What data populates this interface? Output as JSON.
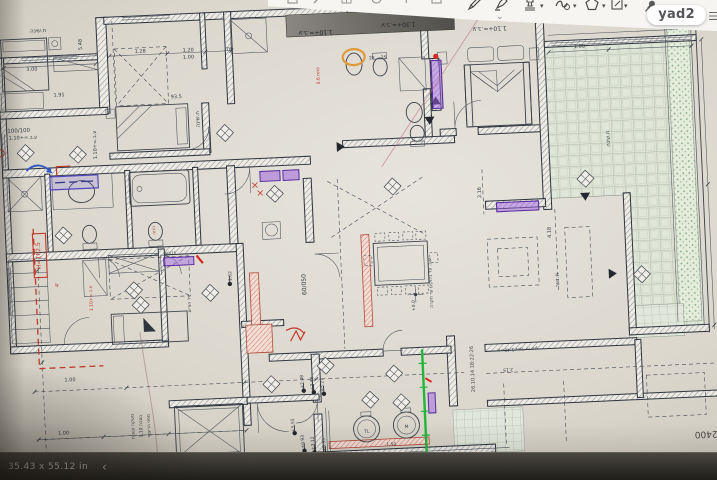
{
  "viewer": {
    "brand": "yad2",
    "size_label": "35.43 x 55.12 in",
    "back_glyph": "‹",
    "menu_glyph": "☰",
    "collapse_glyph": "⌄",
    "caret_glyph": "▾",
    "pencil_glyph": "✎",
    "toolbar_items": [
      "partial-icon",
      "partial-icon",
      "partial-icon",
      "partial-icon",
      "partial-icon",
      "partial-icon",
      "pencil-icon",
      "highlighter-icon",
      "stamp-icon",
      "scribble-icon",
      "shapes-icon",
      "annotate-icon",
      "pin-icon",
      "menu-icon"
    ]
  },
  "plan": {
    "colors": {
      "ink": "#39404a",
      "red": "#c0392b",
      "graphite": "#4a4a44",
      "bartext": "#26272a",
      "green": "#1fae36",
      "purple": "#8e4fd0",
      "orange": "#e09a3c",
      "blue": "#2d57c8",
      "paper": "#dbd7cd"
    },
    "labels": [
      {
        "t": "ח.שינה",
        "x": 48,
        "y": 18,
        "s": 5.5,
        "n": "room-label-bedroom1"
      },
      {
        "t": "3.00",
        "x": 40,
        "y": 56,
        "s": 5
      },
      {
        "t": "1.91",
        "x": 66,
        "y": 83,
        "s": 5
      },
      {
        "t": "5.48",
        "x": 91,
        "y": 32,
        "r": -90,
        "s": 5
      },
      {
        "t": "1.28",
        "x": 149,
        "y": 43,
        "s": 5
      },
      {
        "t": "1.20",
        "x": 197,
        "y": 44,
        "s": 5
      },
      {
        "t": "1.00",
        "x": 197,
        "y": 51,
        "s": 5
      },
      {
        "t": ".76",
        "x": 237,
        "y": 45,
        "s": 5
      },
      {
        "t": "93.5",
        "x": 183,
        "y": 90,
        "s": 5
      },
      {
        "t": "28",
        "x": 380,
        "y": 60,
        "s": 4.5
      },
      {
        "t": "25",
        "x": 392,
        "y": 60,
        "s": 4.5
      },
      {
        "t": "ח.שינה",
        "x": 205,
        "y": 112,
        "r": -90,
        "s": 5.5,
        "n": "room-label-bedroom2"
      },
      {
        "t": "ח.שינה",
        "x": 614,
        "y": 150,
        "r": -90,
        "s": 5.5,
        "n": "room-label-bedroom3"
      },
      {
        "t": "1.00",
        "x": 588,
        "y": 58,
        "s": 5
      },
      {
        "t": "100/100",
        "x": 24,
        "y": 117,
        "s": 5.5
      },
      {
        "t": "ע.ב.=+1.10",
        "x": 28,
        "y": 124,
        "s": 5
      },
      {
        "t": "ע.ב.=+1.10",
        "x": 101,
        "y": 133,
        "r": -90,
        "s": 5
      },
      {
        "t": "H=162.5",
        "x": 40,
        "y": 241,
        "r": -90,
        "s": 6,
        "c": "red",
        "n": "height-note"
      },
      {
        "t": "הזזה",
        "x": 156,
        "y": 221,
        "r": -90,
        "s": 4.5,
        "c": "red"
      },
      {
        "t": "פתח 0.6",
        "x": 327,
        "y": 74,
        "r": -90,
        "s": 4.5,
        "c": "red"
      },
      {
        "t": "4'",
        "x": 57,
        "y": 271,
        "r": -90,
        "s": 5,
        "c": "red"
      },
      {
        "t": "ע.ב.=+1.10",
        "x": 90,
        "y": 286,
        "r": -90,
        "s": 4.5,
        "c": "red"
      },
      {
        "t": "60/050",
        "x": 304,
        "y": 282,
        "r": -90,
        "s": 6,
        "n": "note-60-050"
      },
      {
        "t": "60/75",
        "x": 170,
        "y": 246,
        "s": 4
      },
      {
        "t": "יח' הורים",
        "x": 188,
        "y": 296,
        "r": -90,
        "s": 4.5,
        "n": "room-label-master"
      },
      {
        "t": "+1.62",
        "x": 230,
        "y": 272,
        "r": -90,
        "s": 4.5
      },
      {
        "t": "ע.ב. על בלוקים עד תקרה",
        "x": 430,
        "y": 286,
        "r": -90,
        "s": 4.5
      },
      {
        "t": "+0.0",
        "x": 412,
        "y": 308,
        "r": -90,
        "s": 4.5
      },
      {
        "t": "ח.דיור",
        "x": 557,
        "y": 289,
        "r": -90,
        "s": 5.5,
        "n": "room-label-living"
      },
      {
        "t": "4.18",
        "x": 551,
        "y": 241,
        "r": -90,
        "s": 5
      },
      {
        "t": "2.16",
        "x": 483,
        "y": 198,
        "r": -90,
        "s": 5
      },
      {
        "t": "+2.48",
        "x": 297,
        "y": 379,
        "r": -90,
        "s": 4.5
      },
      {
        "t": "+3.46",
        "x": 307,
        "y": 381,
        "r": -90,
        "s": 4.5
      },
      {
        "t": "+5.27",
        "x": 317,
        "y": 383,
        "r": -90,
        "s": 4.5
      },
      {
        "t": "+0.93",
        "x": 295,
        "y": 439,
        "r": -90,
        "s": 4.5
      },
      {
        "t": "+3.12",
        "x": 305,
        "y": 441,
        "r": -90,
        "s": 4.5
      },
      {
        "t": "+6.35",
        "x": 316,
        "y": 443,
        "r": -90,
        "s": 4.5
      },
      {
        "t": "+5.55",
        "x": 286,
        "y": 422,
        "r": -90,
        "s": 4.5
      },
      {
        "t": "1.00",
        "x": 64,
        "y": 368,
        "s": 5
      },
      {
        "t": "1.00",
        "x": 55,
        "y": 421,
        "s": 5
      },
      {
        "t": "1.50",
        "x": 382,
        "y": 447,
        "s": 4.5
      },
      {
        "t": "1.20",
        "x": 368,
        "y": 462,
        "s": 4.5
      },
      {
        "t": "מעקה זכוכית",
        "x": 126,
        "y": 416,
        "r": -90,
        "s": 4.5
      },
      {
        "t": "בגובה 1.10",
        "x": 134,
        "y": 416,
        "r": -90,
        "s": 4.5
      },
      {
        "t": "מפני הריצוף",
        "x": 142,
        "y": 416,
        "r": -90,
        "s": 4.5
      },
      {
        "t": "26.10.14 18:22:26",
        "x": 468,
        "y": 374,
        "r": -90,
        "s": 5,
        "c": "graphite",
        "n": "handwritten-date"
      },
      {
        "t": "2400",
        "x": 697,
        "y": 447,
        "r": 180,
        "s": 9,
        "c": "graphite",
        "n": "handwritten-2400"
      },
      {
        "t": "מ=1.40 מעל הריצוף",
        "x": 513,
        "y": 355,
        "r": 180,
        "s": 4.5
      },
      {
        "t": "2.15",
        "x": 502,
        "y": 375,
        "r": 180,
        "s": 4.5
      },
      {
        "t": "ע.ב.=+1.30",
        "x": 408,
        "y": 25,
        "r": 180,
        "s": 6,
        "c": "bartext",
        "n": "bar-note"
      },
      {
        "t": "ע.ב.=+1.10",
        "x": 325,
        "y": 29,
        "r": 180,
        "s": 6,
        "c": "bartext",
        "n": "bar-note"
      },
      {
        "t": "ע.ב.=+1.10",
        "x": 499,
        "y": 33,
        "r": 180,
        "s": 6,
        "n": "paper-note"
      },
      {
        "t": "TL",
        "x": 358,
        "y": 433,
        "s": 4.5
      },
      {
        "t": "M",
        "x": 398,
        "y": 430,
        "s": 4.5
      }
    ]
  }
}
